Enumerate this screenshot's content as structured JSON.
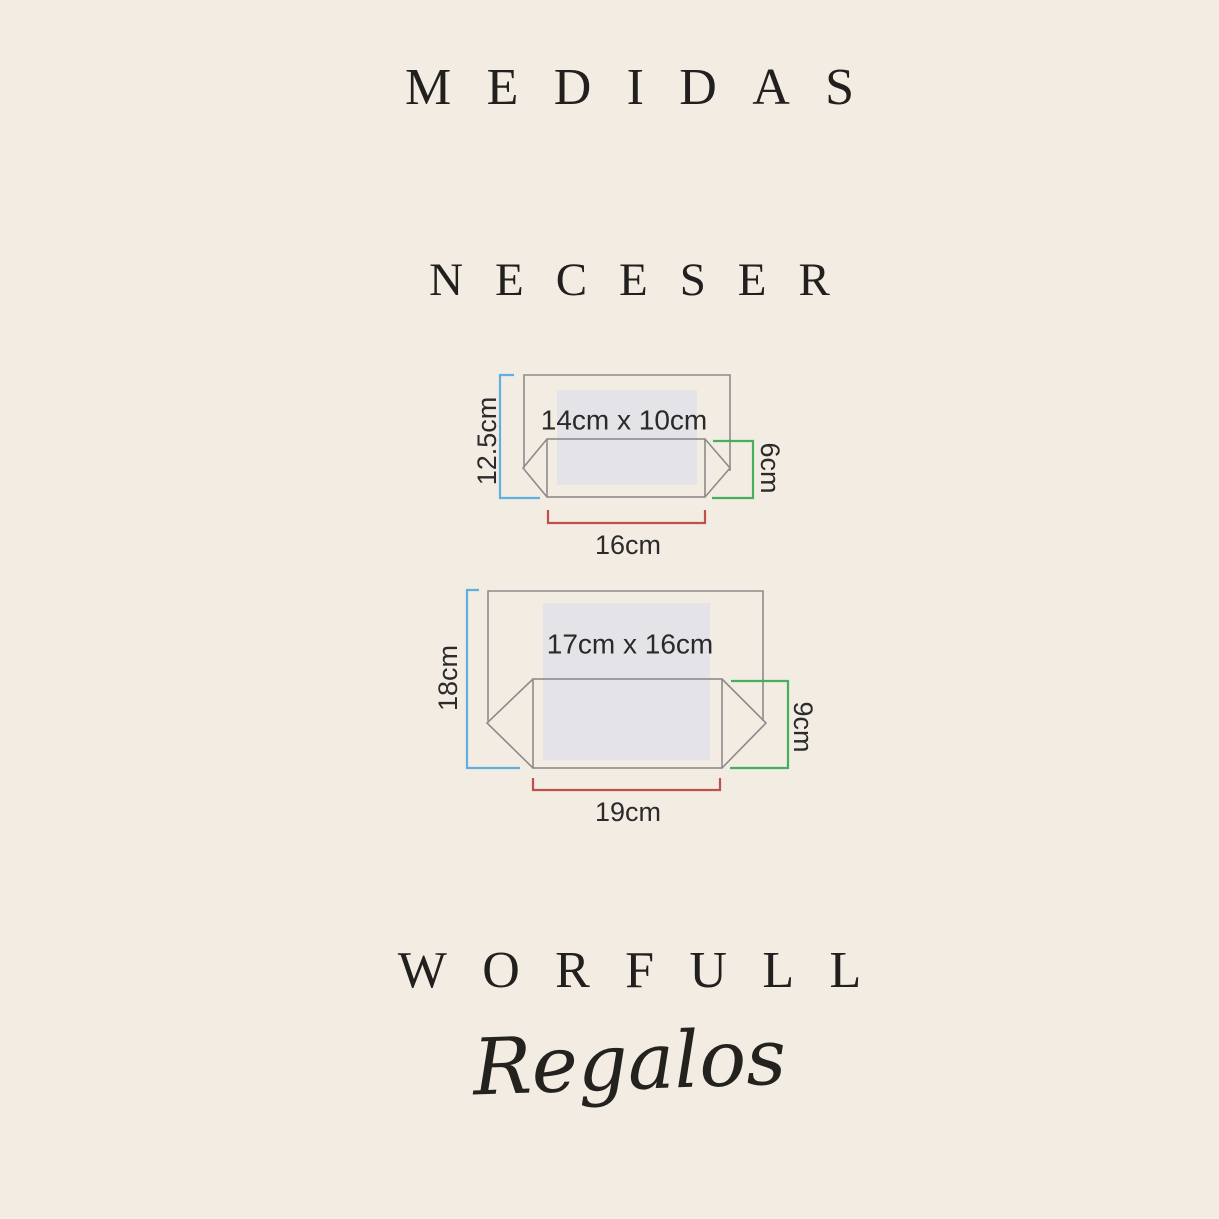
{
  "page": {
    "title": "MEDIDAS",
    "subtitle": "NECESER",
    "brand": "WORFULL",
    "brand_sub": "Regalos"
  },
  "colors": {
    "background": "#f2ece3",
    "heading_text": "#21201e",
    "label_text": "#2b2b2b",
    "outline": "#8d8b8b",
    "panel_fill": "#e3e3e8",
    "height_bracket": "#5fb0df",
    "depth_bracket": "#47ae5b",
    "width_bracket": "#c0504a"
  },
  "diagrams": [
    {
      "name": "neceser-small",
      "print_area": "14cm x 10cm",
      "height": "12.5cm",
      "depth": "6cm",
      "width": "16cm"
    },
    {
      "name": "neceser-large",
      "print_area": "17cm x 16cm",
      "height": "18cm",
      "depth": "9cm",
      "width": "19cm"
    }
  ]
}
